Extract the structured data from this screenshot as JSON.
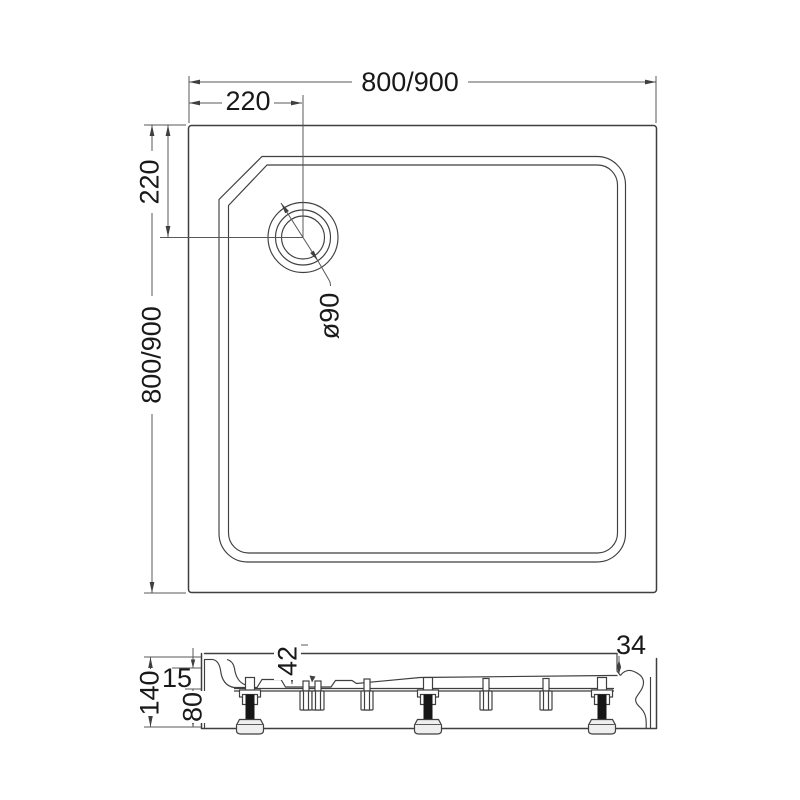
{
  "drawing_type": "shower-tray technical drawing",
  "top_view": {
    "width_label": "800/900",
    "height_label": "800/900",
    "drain_offset_horizontal_label": "220",
    "drain_offset_vertical_label": "220",
    "drain_diameter_label": "ø90"
  },
  "section_view": {
    "overall_height_label": "140",
    "rim_height_label": "15",
    "leg_height_label": "80",
    "drain_recess_depth_label": "42",
    "edge_height_label": "34"
  },
  "colors": {
    "background": "#ffffff",
    "line": "#3f3f3f",
    "dimension_line": "#585858",
    "text": "#191919",
    "foot_dark": "#161616",
    "foot_cap": "#efefef"
  }
}
